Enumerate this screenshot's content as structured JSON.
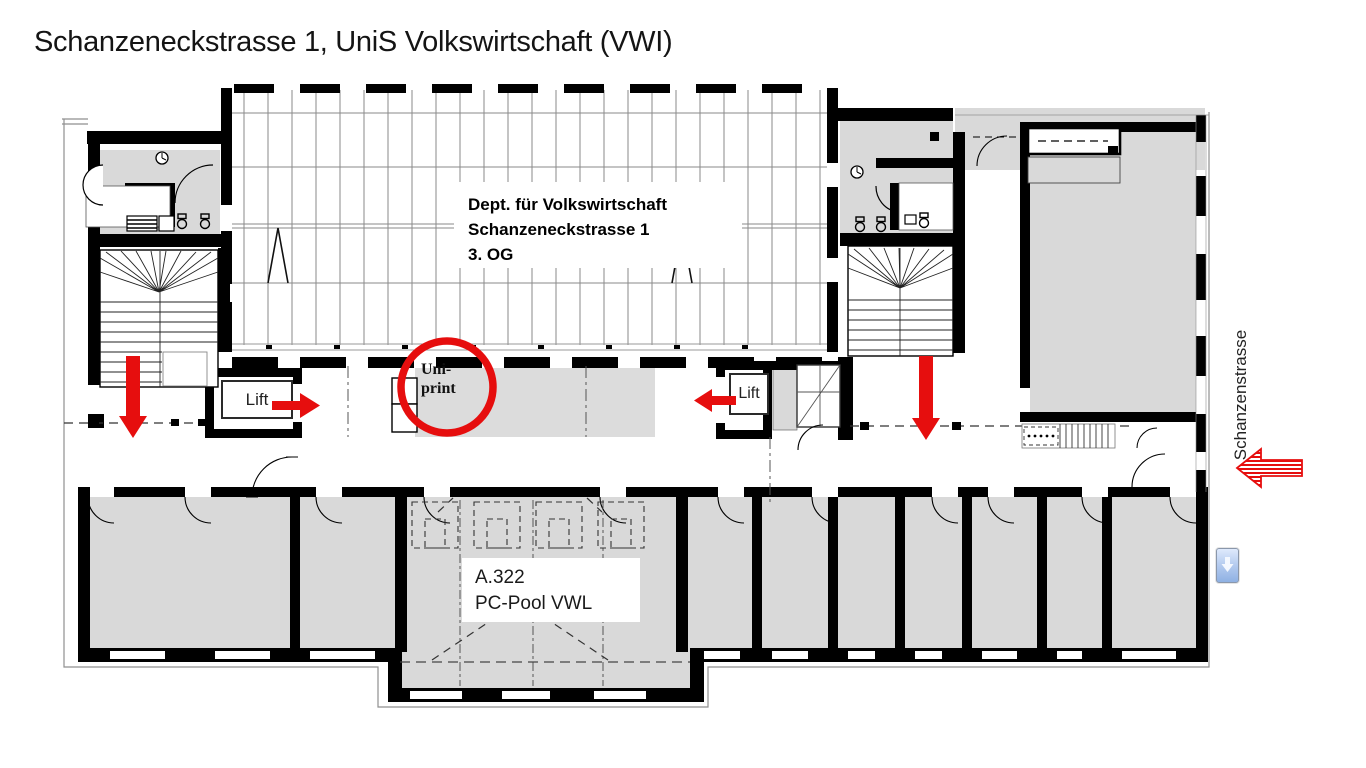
{
  "page": {
    "title": "Schanzeneckstrasse 1, UniS Volkswirtschaft (VWI)"
  },
  "plan": {
    "department_box": {
      "line1": "Dept. für Volkswirtschaft",
      "line2": "Schanzeneckstrasse 1",
      "line3": "3. OG"
    },
    "lift_left": {
      "label": "Lift"
    },
    "lift_right": {
      "label": "Lift"
    },
    "uniprint": {
      "line1": "Uni-",
      "line2": "print"
    },
    "pc_pool": {
      "line1": "A.322",
      "line2": "PC-Pool VWL"
    },
    "street": {
      "label": "Schanzenstrasse"
    },
    "colors": {
      "highlight_red": "#e60e0e",
      "room_fill": "#d9d9d9",
      "wall": "#000000",
      "scroll_button_blue": "#8fb1e3"
    },
    "icons": {
      "down_arrow_left": "red-down-arrow",
      "down_arrow_right": "red-down-arrow",
      "lift_left_arrow": "red-right-arrow",
      "lift_right_arrow": "red-left-arrow",
      "entrance_arrow": "red-striped-left-arrow",
      "uniprint_highlight": "red-circle",
      "scroll_button": "scroll-down-button"
    }
  }
}
